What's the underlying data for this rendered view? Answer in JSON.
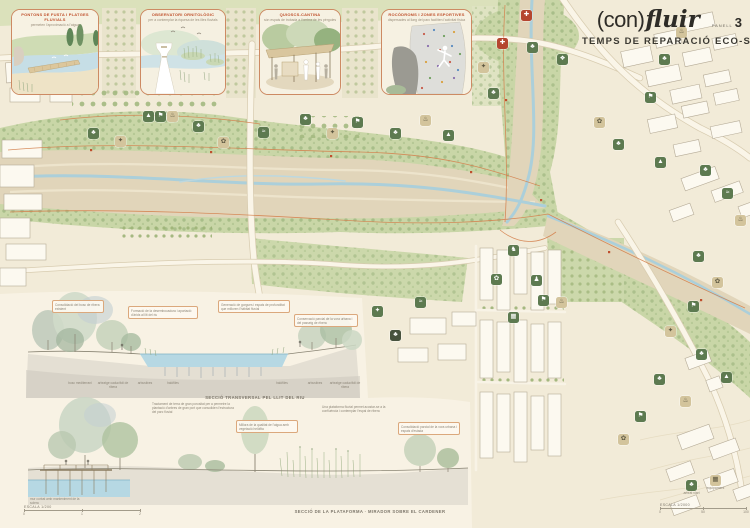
{
  "panel": {
    "title_prefix": "(con)",
    "title_italic": "fluir",
    "panel_label": "PANELL",
    "panel_number": "3",
    "subtitle": "TEMPS DE REPARACIÓ ECO-SOCIAL"
  },
  "insets": [
    {
      "title": "PONTONS DE FUSTA I PLATGES FLUVIALS",
      "subtitle": "permeten l'aproximació a l'aigua"
    },
    {
      "title": "OBSERVATORI ORNITOLÒGIC",
      "subtitle": "per a contemplar la riquesa de les illes fluvials"
    },
    {
      "title": "QUIOSCS-CANTINA",
      "subtitle": "són espais de trobada a l'ombra de les pèrgoles"
    },
    {
      "title": "ROCÒDROMS I ZONES ESPORTIVES",
      "subtitle": "dispersades al llarg del parc faciliten l'activitat física"
    }
  ],
  "sections": {
    "section1": {
      "caption": "SECCIÓ TRANSVERSAL PEL LLIT DEL RIU",
      "labels": [
        {
          "text": "bosc mediterrani",
          "x": 80
        },
        {
          "text": "arbratge caducifoli de ribera",
          "x": 113
        },
        {
          "text": "arbustives",
          "x": 145
        },
        {
          "text": "halòfiles",
          "x": 173
        },
        {
          "text": "halòfiles",
          "x": 282
        },
        {
          "text": "arbustives",
          "x": 315
        },
        {
          "text": "arbratge caducifoli de ribera",
          "x": 345
        }
      ]
    },
    "section2": {
      "caption": "SECCIÓ DE LA PLATAFORMA · MIRADOR SOBRE EL CARDENER"
    },
    "annotations": [
      {
        "type": "callout",
        "x": 52,
        "y": 300,
        "w": 46,
        "text": "Consolidació del bosc de ribera existent"
      },
      {
        "type": "callout",
        "x": 128,
        "y": 306,
        "w": 64,
        "text": "Formació de la desembocadura i aportació d'àrids al llit del riu"
      },
      {
        "type": "callout",
        "x": 218,
        "y": 300,
        "w": 66,
        "text": "Generació de gorgues i espais de profunditat que milloren l'hàbitat fluvial"
      },
      {
        "type": "callout",
        "x": 294,
        "y": 314,
        "w": 58,
        "text": "Conservació parcial de la vora urbana i del passeig de ribera"
      },
      {
        "type": "note",
        "x": 152,
        "y": 402,
        "w": 86,
        "text": "Tractament de terra de gran porositat per a permetre la plantació d'arbres de gran port que consoliden l'estructura del parc fluvial"
      },
      {
        "type": "note",
        "x": 322,
        "y": 405,
        "w": 74,
        "text": "Una plataforma fluvial permet acostar-se a la confluència i contemplar l'espai de ribera"
      },
      {
        "type": "callout",
        "x": 236,
        "y": 420,
        "w": 56,
        "text": "Millora de la qualitat de l'aigua amb vegetació helòfita"
      },
      {
        "type": "callout",
        "x": 398,
        "y": 422,
        "w": 56,
        "text": "Consolidació parcial de la vora urbana i espais d'estada"
      },
      {
        "type": "note",
        "x": 30,
        "y": 497,
        "w": 58,
        "text": "mur corbat amb manteniment de la solera"
      }
    ]
  },
  "scales": {
    "left": {
      "label": "ESCALA 1/200",
      "ticks": [
        "0",
        "1",
        "2"
      ]
    },
    "right": {
      "label": "ESCALA 1/2000",
      "ticks": [
        "0",
        "50",
        "100"
      ]
    }
  },
  "map_icons": [
    {
      "name": "tree-area",
      "variant": "green",
      "glyph": "♣",
      "x": 88,
      "y": 128
    },
    {
      "name": "picnic-area",
      "variant": "tan",
      "glyph": "✦",
      "x": 115,
      "y": 136
    },
    {
      "name": "playground",
      "variant": "green",
      "glyph": "▲",
      "x": 143,
      "y": 111
    },
    {
      "name": "sports-area",
      "variant": "green",
      "glyph": "⚑",
      "x": 155,
      "y": 111
    },
    {
      "name": "kiosk",
      "variant": "tan",
      "glyph": "♨",
      "x": 167,
      "y": 111
    },
    {
      "name": "tree-area",
      "variant": "green",
      "glyph": "♣",
      "x": 193,
      "y": 121
    },
    {
      "name": "garden",
      "variant": "tan",
      "glyph": "✿",
      "x": 218,
      "y": 137
    },
    {
      "name": "river-beach",
      "variant": "green",
      "glyph": "≈",
      "x": 258,
      "y": 127
    },
    {
      "name": "tree-area",
      "variant": "green",
      "glyph": "♣",
      "x": 300,
      "y": 114
    },
    {
      "name": "picnic-area",
      "variant": "tan",
      "glyph": "✦",
      "x": 327,
      "y": 128
    },
    {
      "name": "sports-area",
      "variant": "green",
      "glyph": "⚑",
      "x": 352,
      "y": 117
    },
    {
      "name": "tree-area",
      "variant": "green",
      "glyph": "♣",
      "x": 390,
      "y": 128
    },
    {
      "name": "kiosk",
      "variant": "tan",
      "glyph": "♨",
      "x": 420,
      "y": 115
    },
    {
      "name": "playground",
      "variant": "green",
      "glyph": "▲",
      "x": 443,
      "y": 130
    },
    {
      "name": "marker",
      "variant": "red",
      "glyph": "✚",
      "x": 521,
      "y": 10
    },
    {
      "name": "tree-area",
      "variant": "green",
      "glyph": "♣",
      "x": 527,
      "y": 42
    },
    {
      "name": "bird-observatory",
      "variant": "green",
      "glyph": "❖",
      "x": 557,
      "y": 54
    },
    {
      "name": "marker",
      "variant": "red",
      "glyph": "✚",
      "x": 497,
      "y": 38
    },
    {
      "name": "picnic-area",
      "variant": "tan",
      "glyph": "✦",
      "x": 478,
      "y": 62
    },
    {
      "name": "tree-area",
      "variant": "green",
      "glyph": "♣",
      "x": 488,
      "y": 88
    },
    {
      "name": "kiosk",
      "variant": "tan",
      "glyph": "♨",
      "x": 676,
      "y": 27
    },
    {
      "name": "tree-area",
      "variant": "green",
      "glyph": "♣",
      "x": 659,
      "y": 54
    },
    {
      "name": "sports-area",
      "variant": "green",
      "glyph": "⚑",
      "x": 645,
      "y": 92
    },
    {
      "name": "garden",
      "variant": "tan",
      "glyph": "✿",
      "x": 594,
      "y": 117
    },
    {
      "name": "tree-area",
      "variant": "green",
      "glyph": "♣",
      "x": 613,
      "y": 139
    },
    {
      "name": "playground",
      "variant": "green",
      "glyph": "▲",
      "x": 655,
      "y": 157
    },
    {
      "name": "tree-area",
      "variant": "green",
      "glyph": "♣",
      "x": 700,
      "y": 165
    },
    {
      "name": "river-beach",
      "variant": "green",
      "glyph": "≈",
      "x": 722,
      "y": 188
    },
    {
      "name": "kiosk",
      "variant": "tan",
      "glyph": "♨",
      "x": 735,
      "y": 215
    },
    {
      "name": "tree-area",
      "variant": "green",
      "glyph": "♣",
      "x": 693,
      "y": 251
    },
    {
      "name": "garden",
      "variant": "tan",
      "glyph": "✿",
      "x": 712,
      "y": 277
    },
    {
      "name": "sports-area",
      "variant": "green",
      "glyph": "⚑",
      "x": 688,
      "y": 301
    },
    {
      "name": "picnic-area",
      "variant": "tan",
      "glyph": "✦",
      "x": 665,
      "y": 326
    },
    {
      "name": "tree-area",
      "variant": "green",
      "glyph": "♣",
      "x": 696,
      "y": 349
    },
    {
      "name": "playground",
      "variant": "green",
      "glyph": "▲",
      "x": 721,
      "y": 372
    },
    {
      "name": "kiosk",
      "variant": "tan",
      "glyph": "♨",
      "x": 680,
      "y": 396
    },
    {
      "name": "tree-area",
      "variant": "green",
      "glyph": "♣",
      "x": 654,
      "y": 374
    },
    {
      "name": "sports-area",
      "variant": "green",
      "glyph": "⚑",
      "x": 635,
      "y": 411
    },
    {
      "name": "garden",
      "variant": "tan",
      "glyph": "✿",
      "x": 618,
      "y": 434
    },
    {
      "name": "dog-area",
      "variant": "green",
      "glyph": "♞",
      "x": 508,
      "y": 245
    },
    {
      "name": "garden",
      "variant": "green",
      "glyph": "✿",
      "x": 491,
      "y": 274
    },
    {
      "name": "rest-area",
      "variant": "green",
      "glyph": "♟",
      "x": 531,
      "y": 275
    },
    {
      "name": "sports-area",
      "variant": "green",
      "glyph": "⚑",
      "x": 538,
      "y": 295
    },
    {
      "name": "cafe",
      "variant": "tan",
      "glyph": "♨",
      "x": 556,
      "y": 297
    },
    {
      "name": "bus-stop",
      "variant": "green",
      "glyph": "▦",
      "x": 508,
      "y": 312
    },
    {
      "name": "river-beach",
      "variant": "green",
      "glyph": "≈",
      "x": 415,
      "y": 297
    },
    {
      "name": "tree-area",
      "variant": "dark",
      "glyph": "♣",
      "x": 390,
      "y": 330
    },
    {
      "name": "picnic-area",
      "variant": "green",
      "glyph": "✦",
      "x": 372,
      "y": 306
    },
    {
      "name": "street-trees",
      "variant": "green",
      "glyph": "♣",
      "x": 686,
      "y": 480,
      "label": "arbrat viari"
    },
    {
      "name": "equipment",
      "variant": "tan",
      "glyph": "▦",
      "x": 710,
      "y": 475,
      "label": "equipament"
    }
  ],
  "colors": {
    "paper": "#f7f1e2",
    "accent_red": "#c0532f",
    "tile_green": "#5d7a50",
    "tile_tan": "#d3c49c",
    "river_blue": "#abcfda",
    "park_green": "#c9d6a7"
  }
}
